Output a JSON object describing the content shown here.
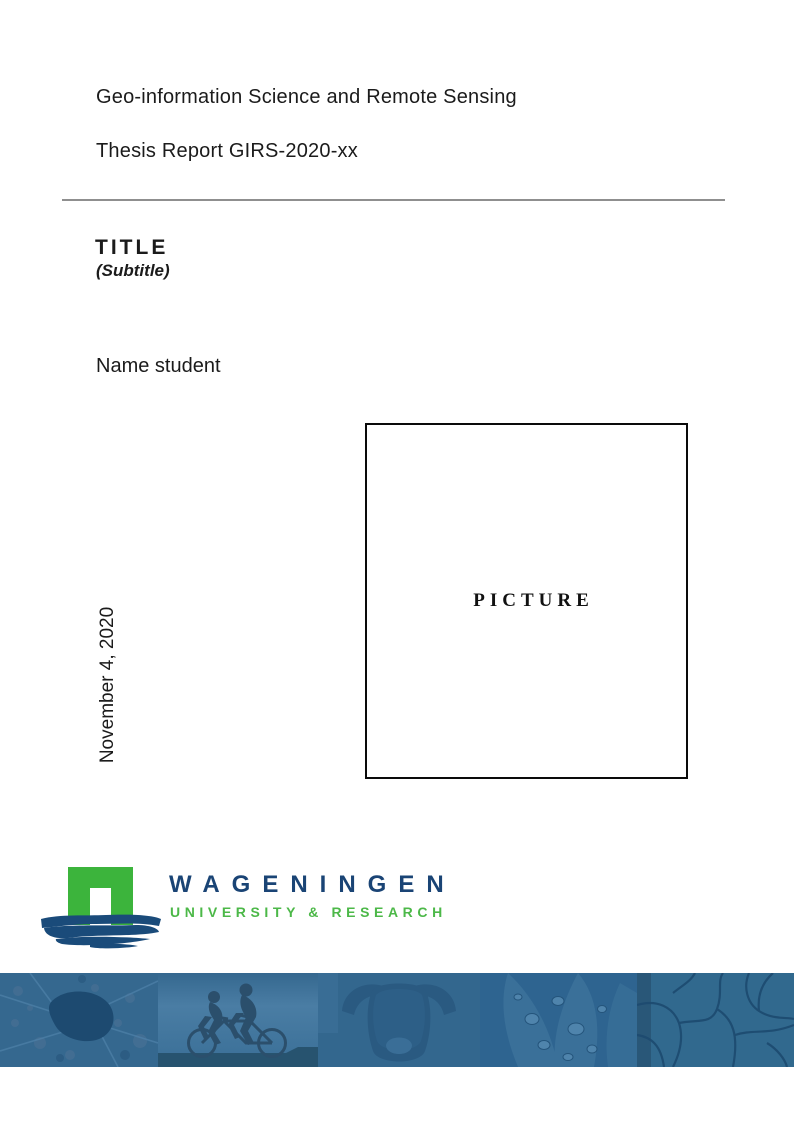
{
  "doc": {
    "program": "Geo-information Science and Remote Sensing",
    "report_number": "Thesis Report GIRS-2020-xx",
    "title": "TITLE",
    "subtitle": "(Subtitle)",
    "author": "Name student",
    "date": "November 4, 2020",
    "picture_placeholder": "PICTURE"
  },
  "logo": {
    "wordmark": "WAGENINGEN",
    "tagline": "UNIVERSITY & RESEARCH",
    "colors": {
      "green": "#3CB43C",
      "navy": "#1A4475",
      "tagline_green": "#4CB848"
    }
  },
  "banner": {
    "panels": [
      "aerial-map",
      "tandem-cyclists",
      "highland-cow",
      "leaf-water-droplets",
      "cracked-earth"
    ],
    "colors": {
      "base": "#33678E",
      "dark": "#1D4A70",
      "light": "#4A7BA3"
    }
  }
}
